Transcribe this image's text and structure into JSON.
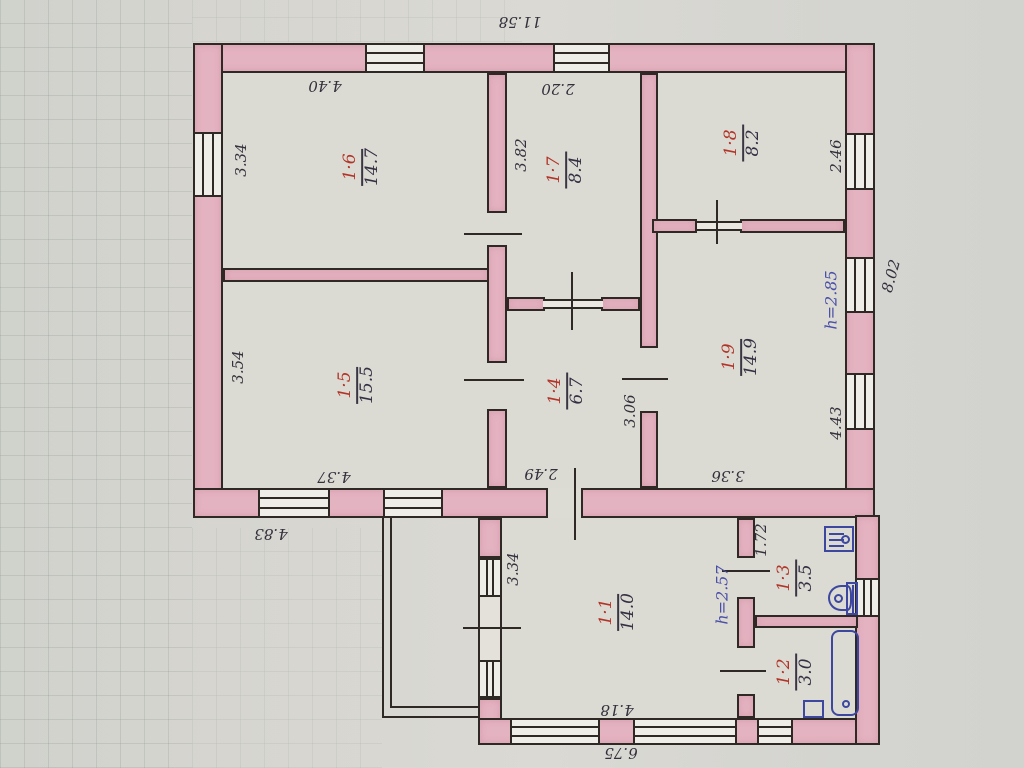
{
  "rooms": [
    {
      "number": "1·6",
      "area": "14.7"
    },
    {
      "number": "1·7",
      "area": "8.4"
    },
    {
      "number": "1·8",
      "area": "8.2"
    },
    {
      "number": "1·5",
      "area": "15.5"
    },
    {
      "number": "1·4",
      "area": "6.7"
    },
    {
      "number": "1·9",
      "area": "14.9"
    },
    {
      "number": "1·1",
      "area": "14.0"
    },
    {
      "number": "1·3",
      "area": "3.5"
    },
    {
      "number": "1·2",
      "area": "3.0"
    }
  ],
  "dimensions": {
    "overall_top": "11.58",
    "r16_top": "4.40",
    "r17_top": "2.20",
    "r16_left": "3.34",
    "r15_left": "3.54",
    "r17_left": "3.82",
    "r18_right": "2.46",
    "right_overall": "8.02",
    "r19_right": "4.43",
    "r14_right": "3.06",
    "r14_bottom": "2.49",
    "r15_bottom": "4.37",
    "bottom_left": "4.83",
    "r19_bottom": "3.36",
    "r11_left": "3.34",
    "r13_top": "1.72",
    "r11_bottom": "4.18",
    "overall_bottom": "6.75"
  },
  "heights": {
    "upper": "h=2.85",
    "lower": "h=2.57"
  },
  "colors": {
    "wall_fill": "#e4b3c1",
    "ink": "#2e2924",
    "room_number": "#b23428",
    "fixtures": "#3d47a0",
    "height_note": "#4a4fa8",
    "paper": "#d6d5d0"
  }
}
